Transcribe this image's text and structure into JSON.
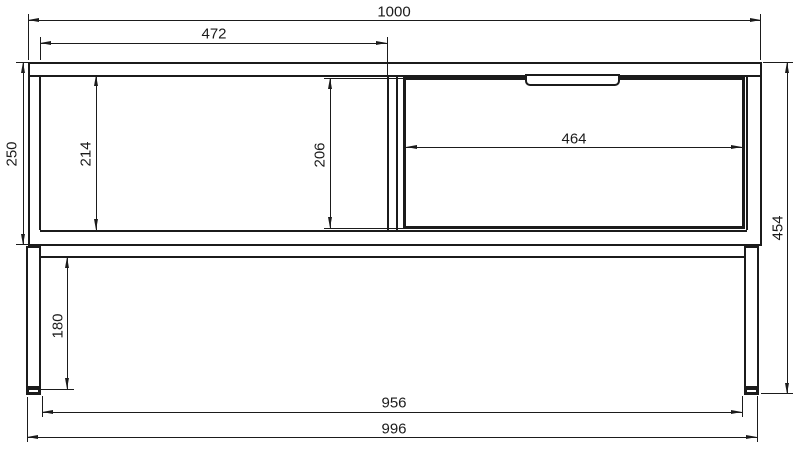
{
  "drawing": {
    "kind": "furniture dimension drawing",
    "view": "front elevation"
  },
  "dims": {
    "overall_width": "1000",
    "left_compartment_width": "472",
    "drawer_inner_width": "464",
    "cabinet_height": "250",
    "left_compartment_height": "214",
    "drawer_front_height": "206",
    "overall_height": "454",
    "leg_height": "180",
    "legs_inner_span": "956",
    "legs_outer_span": "996"
  },
  "colors": {
    "ink": "#1b1b1b",
    "background": "#ffffff"
  }
}
